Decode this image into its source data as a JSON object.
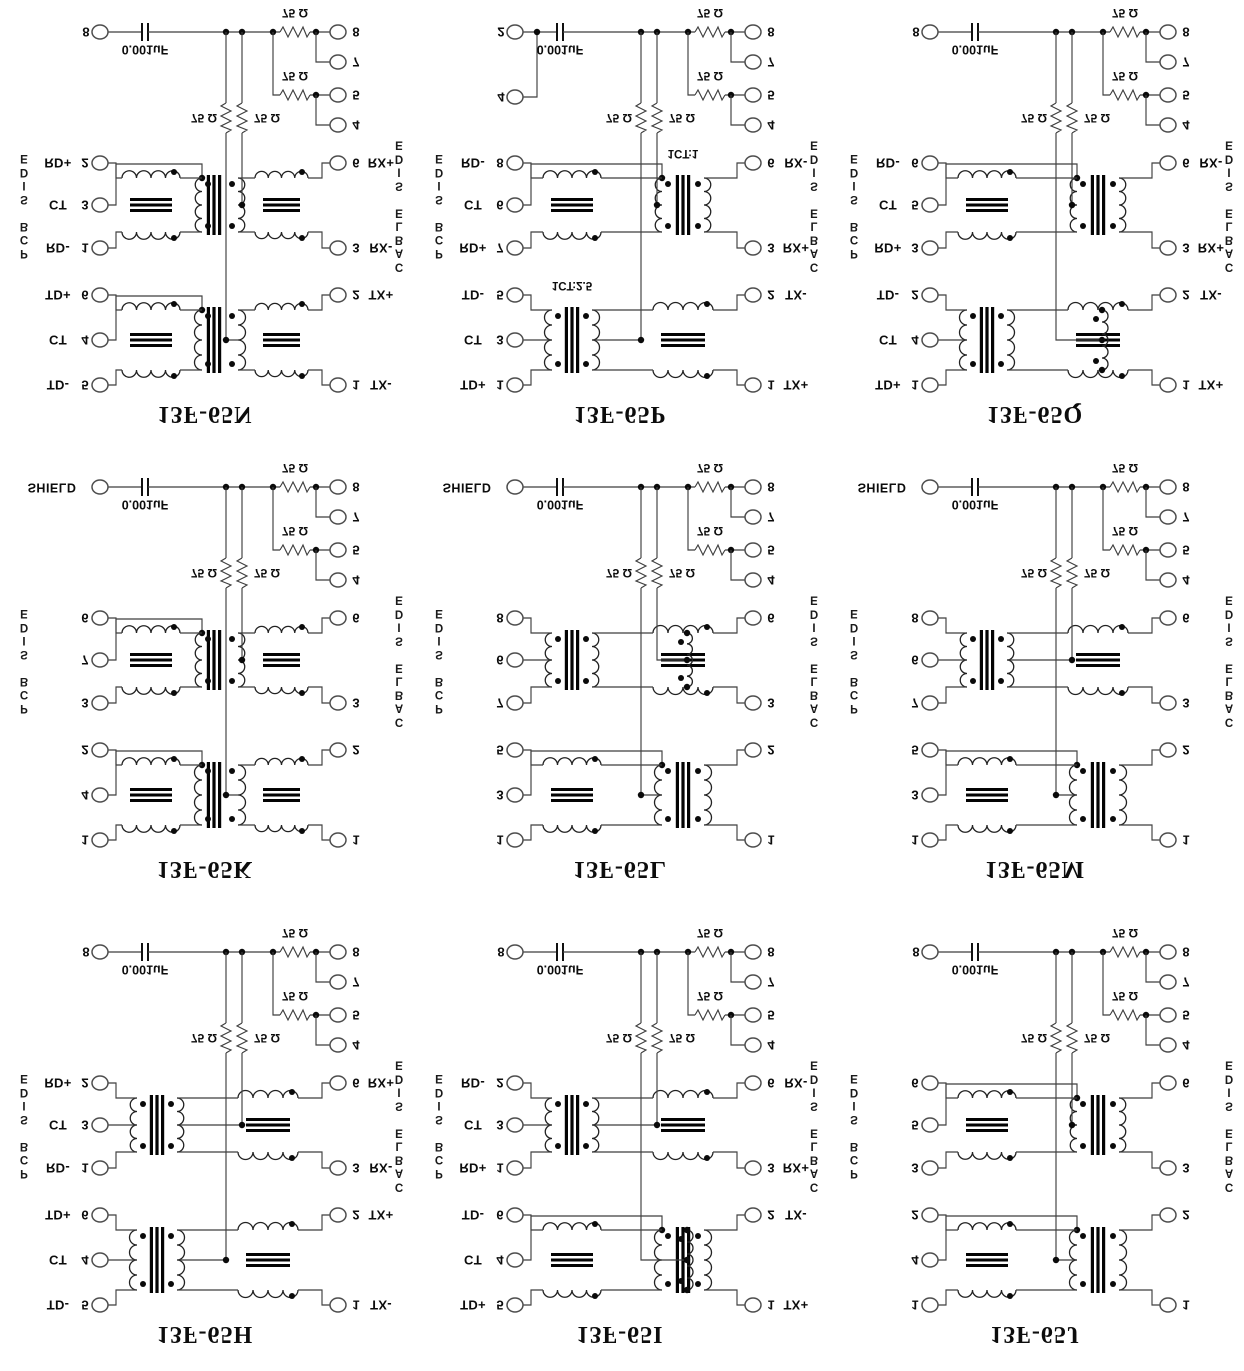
{
  "shared": {
    "pcb_side": "PCB SIDE",
    "cable_side": "CABLE SIDE",
    "cap_value": "0.001uF",
    "resistor_value": "75 Ω",
    "ink_color": "#0c0c0c"
  },
  "cells": [
    {
      "title": "13F-65N",
      "shield_pin": "8",
      "extra_pin": null,
      "left_pins": [
        {
          "label": "RD+",
          "num": "2"
        },
        {
          "label": "CT",
          "num": "3"
        },
        {
          "label": "RD-",
          "num": "1"
        },
        {
          "label": "TD+",
          "num": "6"
        },
        {
          "label": "CT",
          "num": "4"
        },
        {
          "label": "TD-",
          "num": "5"
        }
      ],
      "right_pins": [
        {
          "num": "6",
          "label": "RX+"
        },
        {
          "num": "3",
          "label": "RX-"
        },
        {
          "num": "2",
          "label": "TX+"
        },
        {
          "num": "1",
          "label": "TX-"
        }
      ],
      "unused_cable_pins": [
        "8",
        "7",
        "5",
        "4"
      ],
      "rx_ratio": null,
      "tx_ratio": null
    },
    {
      "title": "13F-65P",
      "shield_pin": "2",
      "extra_pin": "4",
      "left_pins": [
        {
          "label": "RD-",
          "num": "8"
        },
        {
          "label": "CT",
          "num": "6"
        },
        {
          "label": "RD+",
          "num": "7"
        },
        {
          "label": "TD-",
          "num": "5"
        },
        {
          "label": "CT",
          "num": "3"
        },
        {
          "label": "TD+",
          "num": "1"
        }
      ],
      "right_pins": [
        {
          "num": "6",
          "label": "RX-"
        },
        {
          "num": "3",
          "label": "RX+"
        },
        {
          "num": "2",
          "label": "TX-"
        },
        {
          "num": "1",
          "label": "TX+"
        }
      ],
      "unused_cable_pins": [
        "8",
        "7",
        "5",
        "4"
      ],
      "rx_ratio": "1CT:1",
      "tx_ratio": "1CT:2.5"
    },
    {
      "title": "13F-65Q",
      "shield_pin": "8",
      "extra_pin": null,
      "left_pins": [
        {
          "label": "RD-",
          "num": "6"
        },
        {
          "label": "CT",
          "num": "5"
        },
        {
          "label": "RD+",
          "num": "3"
        },
        {
          "label": "TD-",
          "num": "2"
        },
        {
          "label": "CT",
          "num": "4"
        },
        {
          "label": "TD+",
          "num": "1"
        }
      ],
      "right_pins": [
        {
          "num": "6",
          "label": "RX-"
        },
        {
          "num": "3",
          "label": "RX+"
        },
        {
          "num": "2",
          "label": "TX-"
        },
        {
          "num": "1",
          "label": "TX+"
        }
      ],
      "unused_cable_pins": [
        "8",
        "7",
        "5",
        "4"
      ],
      "rx_ratio": null,
      "tx_ratio": null
    },
    {
      "title": "13F-65K",
      "shield_pin": "SHIELD",
      "extra_pin": null,
      "left_pins": [
        {
          "label": "",
          "num": "6"
        },
        {
          "label": "",
          "num": "7"
        },
        {
          "label": "",
          "num": "3"
        },
        {
          "label": "",
          "num": "2"
        },
        {
          "label": "",
          "num": "4"
        },
        {
          "label": "",
          "num": "1"
        }
      ],
      "right_pins": [
        {
          "num": "6",
          "label": ""
        },
        {
          "num": "3",
          "label": ""
        },
        {
          "num": "2",
          "label": ""
        },
        {
          "num": "1",
          "label": ""
        }
      ],
      "unused_cable_pins": [
        "8",
        "7",
        "5",
        "4"
      ],
      "rx_ratio": null,
      "tx_ratio": null
    },
    {
      "title": "13F-65L",
      "shield_pin": "SHIELD",
      "extra_pin": null,
      "left_pins": [
        {
          "label": "",
          "num": "8"
        },
        {
          "label": "",
          "num": "6"
        },
        {
          "label": "",
          "num": "7"
        },
        {
          "label": "",
          "num": "5"
        },
        {
          "label": "",
          "num": "3"
        },
        {
          "label": "",
          "num": "1"
        }
      ],
      "right_pins": [
        {
          "num": "6",
          "label": ""
        },
        {
          "num": "3",
          "label": ""
        },
        {
          "num": "2",
          "label": ""
        },
        {
          "num": "1",
          "label": ""
        }
      ],
      "unused_cable_pins": [
        "8",
        "7",
        "5",
        "4"
      ],
      "rx_ratio": null,
      "tx_ratio": null
    },
    {
      "title": "13F-65M",
      "shield_pin": "SHIELD",
      "extra_pin": null,
      "left_pins": [
        {
          "label": "",
          "num": "8"
        },
        {
          "label": "",
          "num": "6"
        },
        {
          "label": "",
          "num": "7"
        },
        {
          "label": "",
          "num": "5"
        },
        {
          "label": "",
          "num": "3"
        },
        {
          "label": "",
          "num": "1"
        }
      ],
      "right_pins": [
        {
          "num": "6",
          "label": ""
        },
        {
          "num": "3",
          "label": ""
        },
        {
          "num": "2",
          "label": ""
        },
        {
          "num": "1",
          "label": ""
        }
      ],
      "unused_cable_pins": [
        "8",
        "7",
        "5",
        "4"
      ],
      "rx_ratio": null,
      "tx_ratio": null
    },
    {
      "title": "13F-65H",
      "shield_pin": "8",
      "extra_pin": null,
      "left_pins": [
        {
          "label": "RD+",
          "num": "2"
        },
        {
          "label": "CT",
          "num": "3"
        },
        {
          "label": "RD-",
          "num": "1"
        },
        {
          "label": "TD+",
          "num": "6"
        },
        {
          "label": "CT",
          "num": "4"
        },
        {
          "label": "TD-",
          "num": "5"
        }
      ],
      "right_pins": [
        {
          "num": "6",
          "label": "RX+"
        },
        {
          "num": "3",
          "label": "RX-"
        },
        {
          "num": "2",
          "label": "TX+"
        },
        {
          "num": "1",
          "label": "TX-"
        }
      ],
      "unused_cable_pins": [
        "8",
        "7",
        "5",
        "4"
      ],
      "rx_ratio": null,
      "tx_ratio": null
    },
    {
      "title": "13F-65I",
      "shield_pin": "8",
      "extra_pin": null,
      "left_pins": [
        {
          "label": "RD-",
          "num": "2"
        },
        {
          "label": "CT",
          "num": "3"
        },
        {
          "label": "RD+",
          "num": "1"
        },
        {
          "label": "TD-",
          "num": "6"
        },
        {
          "label": "CT",
          "num": "4"
        },
        {
          "label": "TD+",
          "num": "5"
        }
      ],
      "right_pins": [
        {
          "num": "6",
          "label": "RX-"
        },
        {
          "num": "3",
          "label": "RX+"
        },
        {
          "num": "2",
          "label": "TX-"
        },
        {
          "num": "1",
          "label": "TX+"
        }
      ],
      "unused_cable_pins": [
        "8",
        "7",
        "5",
        "4"
      ],
      "rx_ratio": null,
      "tx_ratio": null
    },
    {
      "title": "13F-65J",
      "shield_pin": "8",
      "extra_pin": null,
      "left_pins": [
        {
          "label": "",
          "num": "6"
        },
        {
          "label": "",
          "num": "5"
        },
        {
          "label": "",
          "num": "3"
        },
        {
          "label": "",
          "num": "2"
        },
        {
          "label": "",
          "num": "4"
        },
        {
          "label": "",
          "num": "1"
        }
      ],
      "right_pins": [
        {
          "num": "6",
          "label": ""
        },
        {
          "num": "3",
          "label": ""
        },
        {
          "num": "2",
          "label": ""
        },
        {
          "num": "1",
          "label": ""
        }
      ],
      "unused_cable_pins": [
        "8",
        "7",
        "5",
        "4"
      ],
      "rx_ratio": null,
      "tx_ratio": null
    }
  ]
}
